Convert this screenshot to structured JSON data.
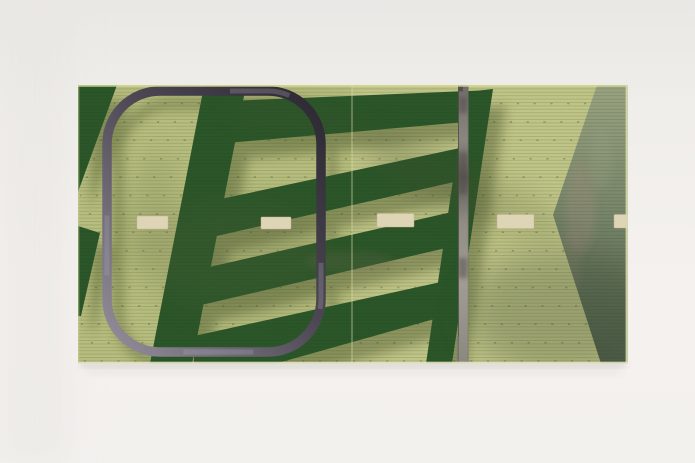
{
  "scene": {
    "description": "Photograph of an abstract green artwork panel (diptych print resembling an aerial field view) lying on a warm white studio backdrop. Dark green ladder-like bars and wedges over light yellow-green ground, a charcoal rounded-rectangle outline, a gray vertical strip, a sage-green wedge on the right, and a row of cream dashes across the middle.",
    "canvas": {
      "w": 695,
      "h": 463
    }
  },
  "backdrop": {
    "stops": [
      [
        "0",
        "#eae8e5"
      ],
      [
        "0.25",
        "#f0eeea"
      ],
      [
        "0.62",
        "#f4f1ee"
      ],
      [
        "1",
        "#f3f1ee"
      ]
    ],
    "left_shade": {
      "x": 0,
      "w": 70,
      "fill": "#e7e5e2",
      "opacity": 0.5
    }
  },
  "panel": {
    "x": 78,
    "y": 85,
    "w": 550,
    "h": 278.5,
    "base": "#b6bd7e",
    "right_half": {
      "x": 352,
      "fill": "#c6ca8e",
      "opacity": 0.55
    },
    "seam": {
      "x": 352,
      "color": "#dcdda6",
      "opacity": 0.5,
      "width": 1.3
    },
    "edges": {
      "top": {
        "y": 85.9,
        "color": "#dbdb96",
        "width": 1.7,
        "opacity": 0.85
      },
      "left": {
        "x": 78.7,
        "color": "#c9cf94",
        "width": 1.2,
        "opacity": 0.6
      },
      "right": {
        "x": 625.6,
        "w": 2.6,
        "fill": "#d6d8ac",
        "opacity": 0.9
      },
      "bottom": {
        "y": 361.7,
        "h": 1.9,
        "fill": "#e3e1bf",
        "opacity": 0.9
      }
    }
  },
  "texture": {
    "stripes": {
      "period": 3.4,
      "line_h": 1,
      "color": "#2e3516",
      "opacity": 0.15
    },
    "dot_rows": {
      "y0": 103.5,
      "step": 18.4,
      "count": 15,
      "color": "#39421f",
      "opacity": 0.32,
      "width": 1.5,
      "dash": "2.2 14.6"
    }
  },
  "shadow": {
    "dx": 13,
    "dy": 16,
    "color": "#39451f",
    "opacity": 0.38
  },
  "dark_shapes": {
    "fill": "#2a5629",
    "items": [
      {
        "name": "left-wedge-top",
        "points": "78,85 117,85 78,192"
      },
      {
        "name": "left-wedge-lower",
        "points": "78,226 100,233 81,316 78,316"
      },
      {
        "name": "ladder-left-rail",
        "points": "204,86 246,86 192,363.5 150,363.5"
      },
      {
        "name": "ladder-right-rail",
        "points": "466,92 493,89 452,363.5 426,363.5"
      },
      {
        "name": "ladder-rung-1",
        "points": "204,102 492,90 488,120 204,145"
      },
      {
        "name": "ladder-rung-2",
        "points": "216,200 460,148 454,182 208,238"
      },
      {
        "name": "ladder-rung-3",
        "points": "205,268 452,212 446,248 197,306"
      },
      {
        "name": "ladder-rung-4",
        "points": "194,336 450,280 445,316 276,363.5 194,363.5"
      }
    ]
  },
  "right_wedge": {
    "points": "597,85 628,85 628,363.5 601,363.5 553,215",
    "stops": [
      [
        "0",
        "#99a381"
      ],
      [
        "0.45",
        "#78866b"
      ],
      [
        "1",
        "#4d5e48"
      ]
    ],
    "smudges": [
      {
        "cx": 581,
        "cy": 208,
        "rx": 15,
        "ry": 46,
        "fill": "#a5907f",
        "op": 0.3
      },
      {
        "cx": 570,
        "cy": 262,
        "rx": 12,
        "ry": 34,
        "fill": "#9a8878",
        "op": 0.25
      },
      {
        "cx": 601,
        "cy": 158,
        "rx": 12,
        "ry": 32,
        "fill": "#9aa184",
        "op": 0.3
      }
    ]
  },
  "blobs": [
    {
      "cx": 235,
      "cy": 255,
      "rx": 95,
      "ry": 55,
      "rot": 0,
      "fill": "#55603a",
      "op": 0.2,
      "f": "b16"
    },
    {
      "cx": 430,
      "cy": 178,
      "rx": 78,
      "ry": 24,
      "rot": 33,
      "fill": "#45502e",
      "op": 0.22,
      "f": "b12"
    },
    {
      "cx": 562,
      "cy": 312,
      "rx": 95,
      "ry": 62,
      "rot": 0,
      "fill": "#35422d",
      "op": 0.26,
      "f": "b16"
    },
    {
      "cx": 298,
      "cy": 117,
      "rx": 72,
      "ry": 19,
      "rot": 8,
      "fill": "#4a5530",
      "op": 0.16,
      "f": "b12"
    },
    {
      "cx": 505,
      "cy": 205,
      "rx": 64,
      "ry": 21,
      "rot": 28,
      "fill": "#49552f",
      "op": 0.16,
      "f": "b12"
    },
    {
      "cx": 350,
      "cy": 262,
      "rx": 45,
      "ry": 11,
      "rot": 0,
      "fill": "#6b6749",
      "op": 0.26,
      "f": "b8"
    },
    {
      "cx": 150,
      "cy": 210,
      "rx": 22,
      "ry": 60,
      "rot": 12,
      "fill": "#5a6440",
      "op": 0.14,
      "f": "b12"
    }
  ],
  "dashes": {
    "fill": "#ded4b6",
    "stroke": "#c3b791",
    "items": [
      {
        "name": "road-dash-1",
        "x": 137,
        "y": 216,
        "w": 31,
        "h": 13
      },
      {
        "name": "road-dash-2",
        "x": 261,
        "y": 217,
        "w": 30,
        "h": 12
      },
      {
        "name": "road-dash-3",
        "x": 377,
        "y": 213.5,
        "w": 37,
        "h": 13.5
      },
      {
        "name": "road-dash-4",
        "x": 497,
        "y": 214.5,
        "w": 37,
        "h": 14
      },
      {
        "name": "road-dash-5",
        "x": 614,
        "y": 214.5,
        "w": 14,
        "h": 13.5
      }
    ]
  },
  "frame": {
    "x": 107,
    "y": 91,
    "w": 214,
    "h": 261,
    "rx": 53,
    "stroke_w": 9.5,
    "grad": [
      [
        "0",
        "#2c2831"
      ],
      [
        "0.45",
        "#4c4753"
      ],
      [
        "1",
        "#958f9c"
      ]
    ],
    "worn": {
      "color": "#a7a2ae",
      "w": 5,
      "opacity": 0.3,
      "dasharray": "46 88 70 130 60 180",
      "offset": -310
    },
    "shadow": {
      "dx": 11,
      "dy": 13,
      "opacity": 0.3
    }
  },
  "bar": {
    "x": 458,
    "w": 10.5,
    "grad": [
      [
        "0",
        "#6f6d68"
      ],
      [
        "0.2",
        "#8a8780"
      ],
      [
        "0.33",
        "#5e5b55"
      ],
      [
        "0.5",
        "#918e86"
      ],
      [
        "0.72",
        "#a09c93"
      ],
      [
        "1",
        "#8b887f"
      ]
    ],
    "left_edge": {
      "color": "#474440",
      "width": 1,
      "opacity": 0.7
    },
    "right_edge": {
      "color": "#6b6862",
      "width": 0.8,
      "opacity": 0.5
    },
    "top_notch": {
      "x": 458,
      "y": 85,
      "w": 5,
      "h": 6.5,
      "fill": "#54524d"
    },
    "step": {
      "x": 456.8,
      "y": 337,
      "w": 2.2,
      "h": 26.5,
      "fill": "#7b786f",
      "op": 0.8
    },
    "patches": [
      {
        "y": 97,
        "h": 16
      },
      {
        "y": 152,
        "h": 42
      },
      {
        "y": 258,
        "h": 20
      }
    ],
    "patch_fill": "#4f4c47",
    "patch_op": 0.5
  },
  "under_shadow": [
    {
      "x": 80,
      "y": 363.5,
      "w": 546,
      "h": 3.5,
      "fill": "#b8b5ae",
      "op": 0.5,
      "f": "b3"
    },
    {
      "x": 86,
      "y": 366,
      "w": 534,
      "h": 8,
      "fill": "#c5c2bb",
      "op": 0.2,
      "f": "b8"
    }
  ]
}
